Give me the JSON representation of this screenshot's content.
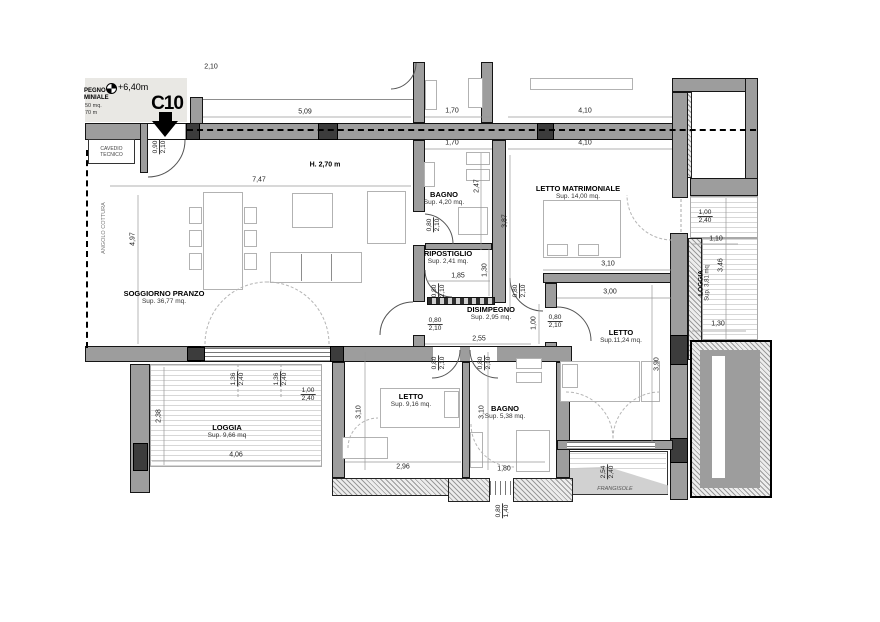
{
  "plan": {
    "unit": {
      "code": "C10",
      "level": "+6,40m",
      "note_line1": "PEGNO",
      "note_line2": "MINIALE",
      "note_line3": "50 mq.",
      "note_line4": "70 m"
    },
    "annotations": {
      "cavedio_line1": "CAVEDIO",
      "cavedio_line2": "TECNICO",
      "angolo_cottura": "ANGOLO COTTURA",
      "ceiling_height": "H. 2,70 m",
      "frangisole": "FRANGISOLE"
    },
    "rooms": {
      "soggiorno": {
        "name": "SOGGIORNO PRANZO",
        "area": "Sup. 36,77 mq."
      },
      "bagno1": {
        "name": "BAGNO",
        "area": "Sup. 4,20 mq."
      },
      "ripostiglio": {
        "name": "RIPOSTIGLIO",
        "area": "Sup. 2,41 mq."
      },
      "disimpegno": {
        "name": "DISIMPEGNO",
        "area": "Sup. 2,95 mq."
      },
      "letto_matr": {
        "name": "LETTO MATRIMONIALE",
        "area": "Sup. 14,00 mq."
      },
      "letto1": {
        "name": "LETTO",
        "area": "Sup.11,24 mq."
      },
      "letto2": {
        "name": "LETTO",
        "area": "Sup. 9,16 mq."
      },
      "bagno2": {
        "name": "BAGNO",
        "area": "Sup. 5,38 mq."
      },
      "loggia1": {
        "name": "LOGGIA",
        "area": "Sup. 9,66 mq"
      },
      "loggia2": {
        "name": "LOGGIA",
        "area": "Sup. 3,81 mq"
      }
    },
    "dims": {
      "d210t": "2,10",
      "d509": "5,09",
      "d170a": "1,70",
      "d170b": "1,70",
      "d410a": "4,10",
      "d410b": "4,10",
      "d747": "7,47",
      "d497": "4,97",
      "d247": "2,47",
      "d387": "3,87",
      "d185": "1,85",
      "d130rip": "1,30",
      "d310lm": "3,10",
      "d300": "3,00",
      "d255": "2,55",
      "d100dis": "1,00",
      "d390": "3,90",
      "d110": "1,10",
      "d346": "3,46",
      "d130lg": "1,30",
      "d238": "2,38",
      "d406": "4,06",
      "d310le": "3,10",
      "d310ba": "3,10",
      "d296": "2,96",
      "d180": "1,80"
    },
    "door_dims": {
      "entrance": {
        "w": "0,90",
        "h": "2,10"
      },
      "d1": {
        "w": "0,80",
        "h": "2,10"
      },
      "d2": {
        "w": "0,80",
        "h": "2,10"
      },
      "d3": {
        "w": "0,80",
        "h": "2,10"
      },
      "d4": {
        "w": "0,80",
        "h": "2,10"
      },
      "d5": {
        "w": "0,80",
        "h": "2,10"
      },
      "d6": {
        "w": "0,80",
        "h": "2,10"
      },
      "d7": {
        "w": "0,80",
        "h": "2,10"
      },
      "w1": {
        "w": "1,00",
        "h": "2,40"
      },
      "w2": {
        "w": "1,36",
        "h": "2,40"
      },
      "w3": {
        "w": "1,36",
        "h": "2,40"
      },
      "w4": {
        "w": "1,00",
        "h": "2,40"
      },
      "w5": {
        "w": "0,80",
        "h": "1,40"
      },
      "w6": {
        "w": "2,54",
        "h": "2,40"
      }
    }
  }
}
